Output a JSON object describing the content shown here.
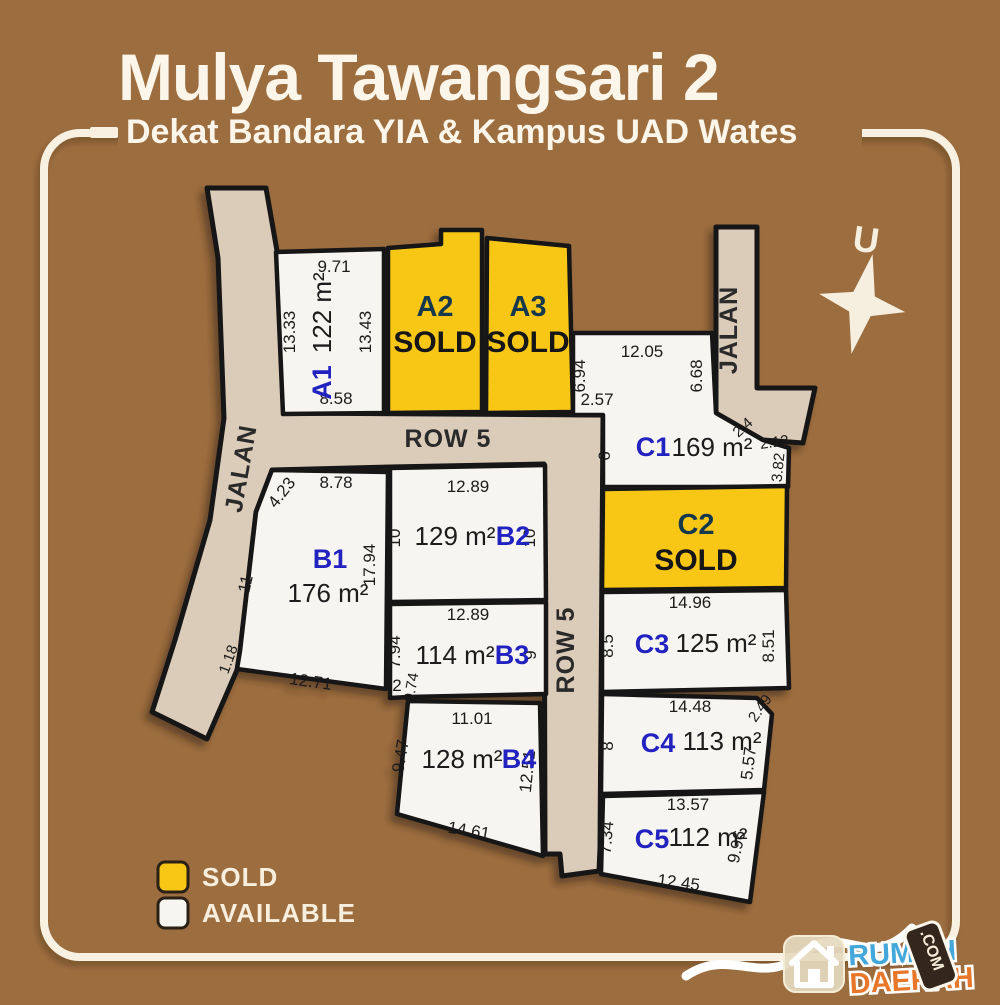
{
  "title": "Mulya Tawangsari 2",
  "subtitle": "Dekat Bandara YIA & Kampus UAD Wates",
  "compass": {
    "north_label": "U"
  },
  "roads": {
    "jalan_left": "JALAN",
    "jalan_right": "JALAN",
    "row5_horizontal": "ROW 5",
    "row5_vertical": "ROW 5"
  },
  "legend": {
    "sold_label": "SOLD",
    "available_label": "AVAILABLE"
  },
  "colors": {
    "background": "#9c6d3f",
    "road": "#dbcbb9",
    "plot_available": "#f7f5f1",
    "plot_sold": "#f8c715",
    "plot_id_blue": "#2424c0",
    "sold_id_dark": "#17394e",
    "outline": "#151515",
    "frame": "#f8f1e2"
  },
  "plots": [
    {
      "id": "A1",
      "status": "available",
      "area": "122 m²",
      "dims": {
        "top": "9.71",
        "left": "13.33",
        "right": "13.43",
        "bottom": "8.58"
      }
    },
    {
      "id": "A2",
      "status": "sold",
      "status_label": "SOLD"
    },
    {
      "id": "A3",
      "status": "sold",
      "status_label": "SOLD"
    },
    {
      "id": "B1",
      "status": "available",
      "area": "176 m²",
      "dims": {
        "top": "8.78",
        "top_left": "4.23",
        "left": "11",
        "bottom_left": "1.18",
        "bottom": "12.71",
        "right": "17.94"
      }
    },
    {
      "id": "B2",
      "status": "available",
      "area": "129 m²",
      "dims": {
        "top": "12.89",
        "left": "10",
        "right": "10"
      }
    },
    {
      "id": "B3",
      "status": "available",
      "area": "114 m²",
      "dims": {
        "top": "12.89",
        "left": "7.94",
        "right": "9",
        "step_width": "2",
        "step_height": "0.74"
      }
    },
    {
      "id": "B4",
      "status": "available",
      "area": "128 m²",
      "dims": {
        "top": "11.01",
        "left": "9.47",
        "right": "12.51",
        "bottom": "14.61"
      }
    },
    {
      "id": "C1",
      "status": "available",
      "area": "169 m²",
      "dims": {
        "top": "12.05",
        "upper_left": "6.94",
        "upper_right": "6.68",
        "step": "2.57",
        "left": "6",
        "diagonal": "2.4",
        "right_upper": "2.13",
        "right_lower": "3.82"
      }
    },
    {
      "id": "C2",
      "status": "sold",
      "status_label": "SOLD"
    },
    {
      "id": "C3",
      "status": "available",
      "area": "125 m²",
      "dims": {
        "top": "14.96",
        "left": "8.5",
        "right": "8.51"
      }
    },
    {
      "id": "C4",
      "status": "available",
      "area": "113 m²",
      "dims": {
        "top": "14.48",
        "left": "8",
        "diagonal": "2.49",
        "right": "5.57"
      }
    },
    {
      "id": "C5",
      "status": "available",
      "area": "112 m²",
      "dims": {
        "top": "13.57",
        "left": "7.34",
        "right": "9.96",
        "bottom": "12.45"
      }
    }
  ],
  "logo": {
    "line1": "RUMAH",
    "line2": "DAERAH",
    "tld": ".COM"
  }
}
